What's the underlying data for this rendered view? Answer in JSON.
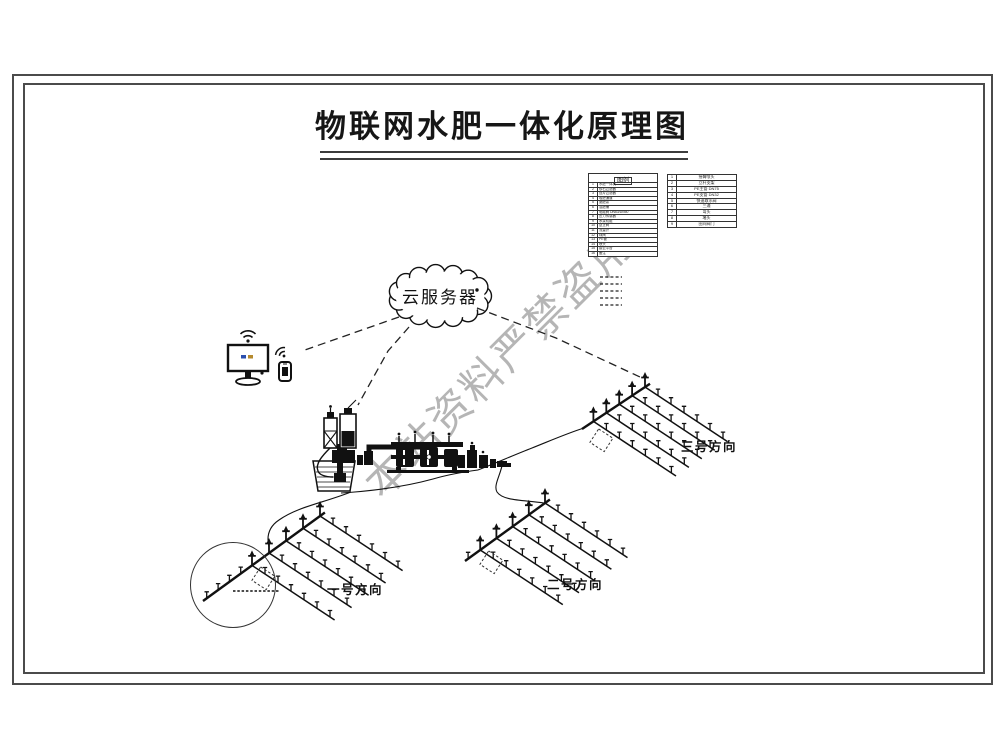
{
  "title": {
    "text": "物联网水肥一体化原理图"
  },
  "watermark": {
    "text": "本站资料严禁盗用",
    "color": "#a3a3a3"
  },
  "cloud": {
    "label": "云服务器"
  },
  "colors": {
    "ink": "#111111",
    "frame": "#4b4b4b",
    "watermark": "#a3a3a3"
  },
  "icons": {
    "wifi": "wifi-icon",
    "monitor": "monitor-icon",
    "phone": "smartphone-icon",
    "cloud": "cloud-server-icon",
    "sprinkler": "sprinkler-icon",
    "pump": "pump-icon",
    "tank": "fertilizer-tank-icon",
    "basin": "water-source-icon"
  },
  "legend": {
    "header": "图例",
    "left_rows": [
      {
        "n": "1",
        "name": "水肥一体机"
      },
      {
        "n": "2",
        "name": "砂石过滤器"
      },
      {
        "n": "3",
        "name": "叠片过滤器"
      },
      {
        "n": "4",
        "name": "吸肥通道"
      },
      {
        "n": "5",
        "name": "施肥泵"
      },
      {
        "n": "6",
        "name": "混肥桶"
      },
      {
        "n": "7",
        "name": "电磁阀 DN63/DN50"
      },
      {
        "n": "8",
        "name": "压力传感器"
      },
      {
        "n": "9",
        "name": "水泵机组"
      },
      {
        "n": "10",
        "name": "逆止阀"
      },
      {
        "n": "11",
        "name": "流量计"
      },
      {
        "n": "12",
        "name": "球阀"
      },
      {
        "n": "13",
        "name": "PE管"
      },
      {
        "n": "14",
        "name": "喷头"
      },
      {
        "n": "15",
        "name": "接云平台"
      },
      {
        "n": "16",
        "name": "备注"
      }
    ],
    "right_rows": [
      {
        "n": "1",
        "name": "摇臂喷头"
      },
      {
        "n": "2",
        "name": "立杆支架"
      },
      {
        "n": "3",
        "name": "PE主管 DN75"
      },
      {
        "n": "4",
        "name": "PE支管 DN32"
      },
      {
        "n": "5",
        "name": "快速取水阀"
      },
      {
        "n": "6",
        "name": "三通"
      },
      {
        "n": "7",
        "name": "弯头"
      },
      {
        "n": "8",
        "name": "堵头"
      },
      {
        "n": "9",
        "name": "田间阀门"
      }
    ]
  },
  "fields": [
    {
      "label": "一号方向"
    },
    {
      "label": "二号方向"
    },
    {
      "label": "三号方向"
    }
  ]
}
